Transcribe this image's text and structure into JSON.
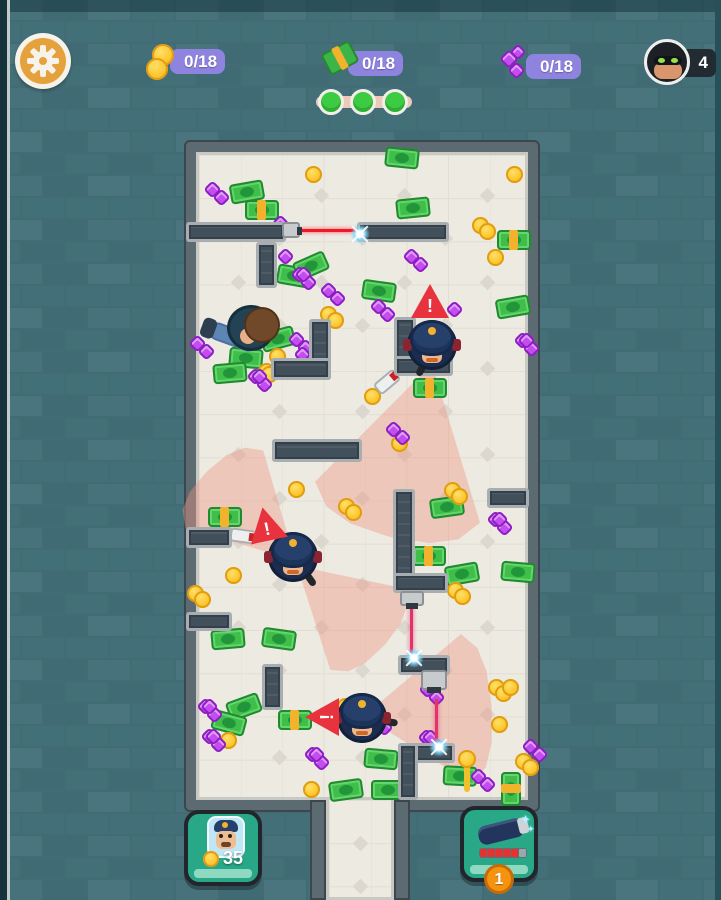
{
  "hud": {
    "coin_counter": "0/18",
    "cash_counter": "0/18",
    "gem_counter": "0/18",
    "robber_count": "4",
    "progress": {
      "total": 3,
      "filled": 3
    }
  },
  "footer": {
    "police_cost": "35",
    "item_count": "1"
  },
  "colors": {
    "accent_badge": "#8e83de",
    "laser_red": "#f01728",
    "laser_pink": "#e0356b",
    "cone_pink": "rgba(238,150,130,0.42)",
    "floor": "#edeae2",
    "wall_brick": "#426b74"
  },
  "scene": {
    "warning_glyph": "!",
    "walls": [
      [
        186,
        222,
        100,
        20
      ],
      [
        357,
        222,
        92,
        20
      ],
      [
        256,
        242,
        21,
        46
      ],
      [
        309,
        319,
        22,
        61
      ],
      [
        271,
        358,
        60,
        22
      ],
      [
        394,
        317,
        22,
        45
      ],
      [
        394,
        356,
        59,
        20
      ],
      [
        272,
        439,
        90,
        23
      ],
      [
        186,
        527,
        46,
        21
      ],
      [
        186,
        612,
        46,
        19
      ],
      [
        262,
        664,
        21,
        46
      ],
      [
        393,
        489,
        22,
        94
      ],
      [
        393,
        573,
        55,
        20
      ],
      [
        398,
        655,
        52,
        20
      ],
      [
        487,
        488,
        42,
        20
      ],
      [
        398,
        743,
        57,
        20
      ],
      [
        398,
        743,
        20,
        57
      ]
    ],
    "lasers": [
      {
        "x": 300,
        "y": 229,
        "w": 57,
        "h": 3,
        "dir": "h"
      },
      {
        "x": 410,
        "y": 606,
        "w": 3,
        "h": 50,
        "dir": "v"
      },
      {
        "x": 435,
        "y": 699,
        "w": 3,
        "h": 46,
        "dir": "v"
      }
    ],
    "sparks": [
      [
        350,
        224
      ],
      [
        404,
        648
      ],
      [
        429,
        737
      ]
    ],
    "emitters": [
      {
        "x": 282,
        "y": 222,
        "w": 18,
        "h": 16,
        "tip": "right"
      },
      {
        "x": 400,
        "y": 591,
        "w": 24,
        "h": 15,
        "tip": "down"
      },
      {
        "x": 421,
        "y": 670,
        "w": 26,
        "h": 20,
        "tip": "down",
        "camera": true
      }
    ],
    "cones": [
      {
        "x": 432,
        "y": 364,
        "w": 170,
        "h": 178,
        "rot": 14
      },
      {
        "x": 295,
        "y": 560,
        "w": 110,
        "h": 125,
        "rot": 135
      },
      {
        "x": 297,
        "y": 566,
        "w": 110,
        "h": 118,
        "rot": -48
      },
      {
        "x": 364,
        "y": 716,
        "w": 150,
        "h": 128,
        "rot": -94
      }
    ],
    "police": [
      {
        "x": 432,
        "y": 345,
        "baton": 118
      },
      {
        "x": 293,
        "y": 557,
        "baton": 55
      },
      {
        "x": 362,
        "y": 718,
        "baton": 8
      }
    ],
    "thief": {
      "x": 250,
      "y": 330
    },
    "warnings": [
      {
        "x": 430,
        "y": 301,
        "rot": 0
      },
      {
        "x": 266,
        "y": 524,
        "rot": -12
      },
      {
        "x": 322,
        "y": 717,
        "rot": -90
      }
    ],
    "flashlights": [
      {
        "x": 387,
        "y": 382,
        "rot": -40
      },
      {
        "x": 243,
        "y": 536,
        "rot": 8
      }
    ],
    "lollipop": {
      "x": 458,
      "y": 750
    },
    "bills": [
      [
        247,
        192,
        -10,
        0
      ],
      [
        262,
        210,
        0,
        1
      ],
      [
        402,
        158,
        6,
        0
      ],
      [
        413,
        208,
        -6,
        0
      ],
      [
        294,
        276,
        10,
        0
      ],
      [
        311,
        266,
        -24,
        0
      ],
      [
        379,
        291,
        8,
        0
      ],
      [
        514,
        240,
        0,
        1
      ],
      [
        513,
        307,
        -10,
        0
      ],
      [
        278,
        339,
        -15,
        0
      ],
      [
        246,
        358,
        5,
        0
      ],
      [
        230,
        373,
        -5,
        0
      ],
      [
        430,
        388,
        0,
        1
      ],
      [
        447,
        507,
        -8,
        0
      ],
      [
        429,
        556,
        0,
        1
      ],
      [
        462,
        574,
        -10,
        0
      ],
      [
        518,
        572,
        5,
        0
      ],
      [
        225,
        517,
        0,
        1
      ],
      [
        228,
        639,
        -5,
        0
      ],
      [
        279,
        639,
        8,
        0
      ],
      [
        244,
        707,
        -20,
        0
      ],
      [
        229,
        723,
        15,
        0
      ],
      [
        295,
        720,
        0,
        1
      ],
      [
        381,
        759,
        5,
        0
      ],
      [
        346,
        790,
        -8,
        0
      ],
      [
        388,
        790,
        0,
        0
      ],
      [
        460,
        776,
        3,
        0
      ],
      [
        511,
        789,
        90,
        1
      ]
    ],
    "coins": [
      [
        313,
        174,
        1
      ],
      [
        514,
        174,
        1
      ],
      [
        480,
        225,
        2
      ],
      [
        495,
        257,
        1
      ],
      [
        328,
        314,
        2
      ],
      [
        277,
        356,
        1
      ],
      [
        266,
        371,
        1
      ],
      [
        269,
        374,
        1
      ],
      [
        399,
        443,
        1
      ],
      [
        372,
        396,
        1
      ],
      [
        452,
        490,
        2
      ],
      [
        296,
        489,
        1
      ],
      [
        346,
        506,
        2
      ],
      [
        233,
        575,
        1
      ],
      [
        195,
        593,
        2
      ],
      [
        455,
        590,
        2
      ],
      [
        496,
        687,
        3
      ],
      [
        499,
        724,
        1
      ],
      [
        228,
        740,
        1
      ],
      [
        311,
        789,
        1
      ],
      [
        523,
        761,
        2
      ],
      [
        345,
        706,
        1
      ]
    ],
    "gems": [
      [
        213,
        190,
        2
      ],
      [
        281,
        224,
        1
      ],
      [
        286,
        257,
        1
      ],
      [
        300,
        275,
        3
      ],
      [
        412,
        257,
        2
      ],
      [
        455,
        310,
        1
      ],
      [
        523,
        341,
        3
      ],
      [
        379,
        307,
        2
      ],
      [
        329,
        291,
        2
      ],
      [
        198,
        344,
        2
      ],
      [
        297,
        340,
        2
      ],
      [
        303,
        355,
        1
      ],
      [
        256,
        377,
        3
      ],
      [
        394,
        430,
        2
      ],
      [
        496,
        520,
        3
      ],
      [
        206,
        707,
        3
      ],
      [
        210,
        737,
        3
      ],
      [
        313,
        755,
        3
      ],
      [
        376,
        720,
        3
      ],
      [
        428,
        690,
        2
      ],
      [
        427,
        738,
        3
      ],
      [
        531,
        747,
        2
      ],
      [
        479,
        777,
        2
      ]
    ]
  }
}
